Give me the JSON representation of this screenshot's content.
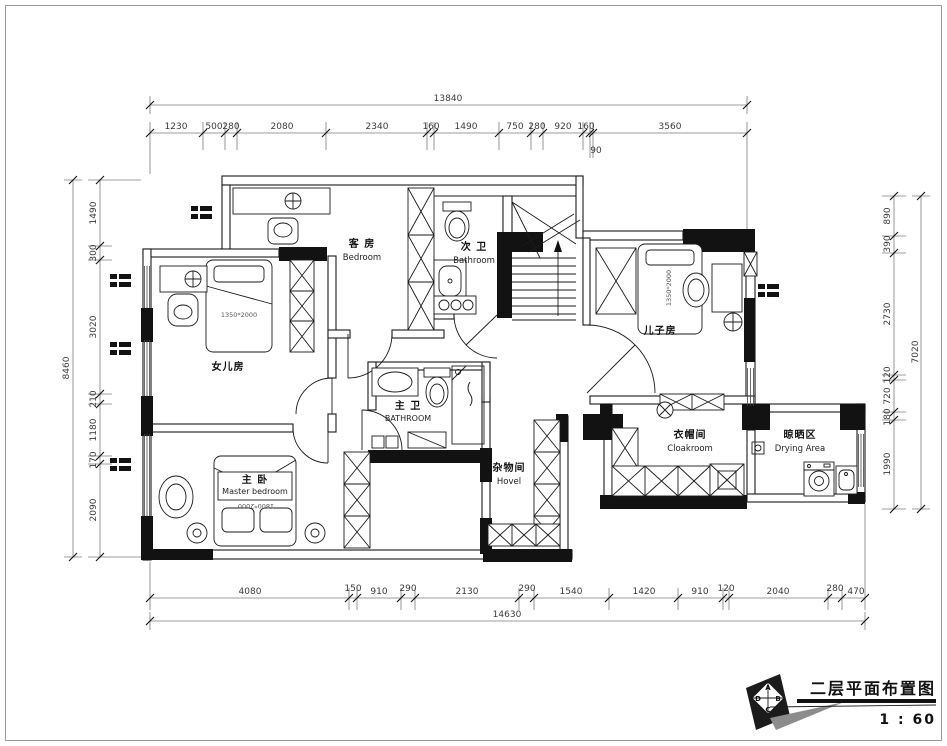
{
  "drawing": {
    "title": "二层平面布置图",
    "scale": "1 : 60"
  },
  "logo": {
    "top": "A",
    "left": "D",
    "right": "B",
    "bottom": "C"
  },
  "rooms": {
    "guest": {
      "cn": "客 房",
      "en": "Bedroom"
    },
    "bath2": {
      "cn": "次 卫",
      "en": "Bathroom"
    },
    "daughter": {
      "cn": "女儿房"
    },
    "master_bath": {
      "cn": "主 卫",
      "en": "BATHROOM"
    },
    "master": {
      "cn": "主 卧",
      "en": "Master  bedroom"
    },
    "son": {
      "cn": "儿子房"
    },
    "storage": {
      "cn": "杂物间",
      "en": "Hovel"
    },
    "cloak": {
      "cn": "衣帽间",
      "en": "Cloakroom"
    },
    "drying": {
      "cn": "晾晒区",
      "en": "Drying  Area"
    }
  },
  "furniture": {
    "daughter_bed": "1350*2000",
    "master_bed": "1800*2000",
    "son_bed": "1350*2000"
  },
  "dimensions": {
    "top": {
      "total": "13840",
      "segments": [
        "1230",
        "500",
        "280",
        "2080",
        "2340",
        "160",
        "1490",
        "750",
        "280",
        "920",
        "160",
        "90",
        "3560"
      ]
    },
    "bottom": {
      "total": "14630",
      "segments": [
        "4080",
        "150",
        "910",
        "290",
        "2130",
        "290",
        "1540",
        "1420",
        "910",
        "120",
        "2040",
        "280",
        "470"
      ]
    },
    "left": {
      "total": "8460",
      "segments": [
        "1490",
        "300",
        "3020",
        "210",
        "1180",
        "170",
        "2090"
      ]
    },
    "right": {
      "total": "7020",
      "segments": [
        "890",
        "390",
        "2730",
        "120",
        "720",
        "180",
        "1990"
      ]
    }
  }
}
